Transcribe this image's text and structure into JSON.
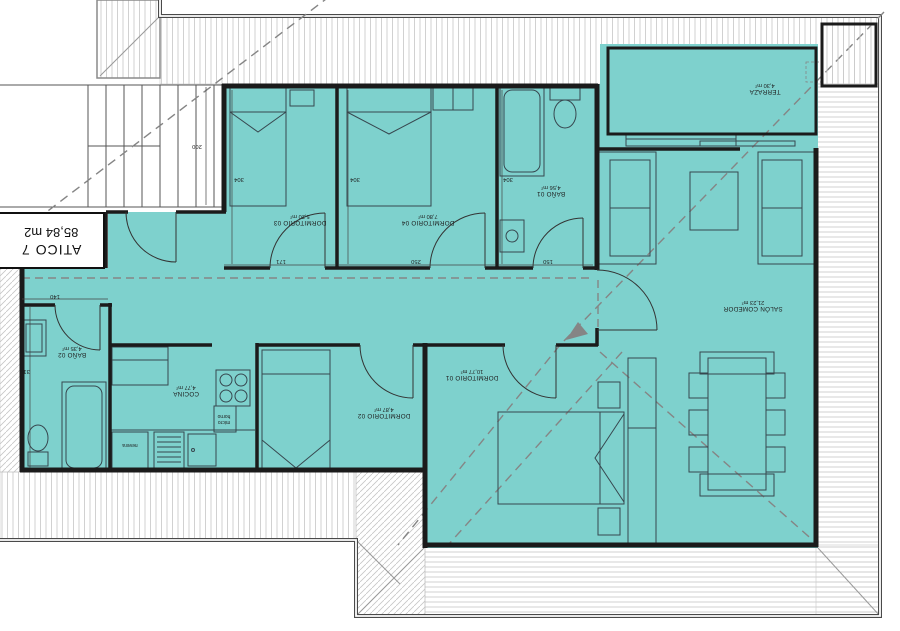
{
  "plan": {
    "title": "ATICO 7",
    "title_area": "85,84 m2"
  },
  "rooms": {
    "dormitorio_03": {
      "label": "DORMITORIO 03",
      "area": "5,20 m²"
    },
    "dormitorio_04": {
      "label": "DORMITORIO 04",
      "area": "7,80 m²"
    },
    "bano_01": {
      "label": "BAÑO 01",
      "area": "4,56 m²"
    },
    "terraza": {
      "label": "TERRAZA",
      "area": "4,30 m²"
    },
    "salon": {
      "label": "SALÓN COMEDOR",
      "area": "21,23 m²"
    },
    "dormitorio_01": {
      "label": "DORMITORIO 01",
      "area": "10,77 m²"
    },
    "dormitorio_02": {
      "label": "DORMITORIO 02",
      "area": "4,87 m²"
    },
    "cocina": {
      "label": "COCINA",
      "area": "4,77 m²"
    },
    "bano_02": {
      "label": "BAÑO 02",
      "area": "4,35 m²"
    }
  },
  "appliance_labels": {
    "fridge": "nevera",
    "microwave_oven": "micro horno"
  },
  "dimensions": {
    "stairs_width": "200",
    "dorm03_depth": "304",
    "dorm04_depth": "304",
    "bano01_depth": "304",
    "dorm03_width": "171",
    "dorm04_width": "250",
    "bano01_width": "150",
    "bano02_door": "140",
    "bano02_depth": "310"
  },
  "colors": {
    "floor": "#7ED1CD",
    "wall": "#1B1B1B",
    "roof_hatch": "#CCCCCC",
    "dash": "#858585"
  }
}
